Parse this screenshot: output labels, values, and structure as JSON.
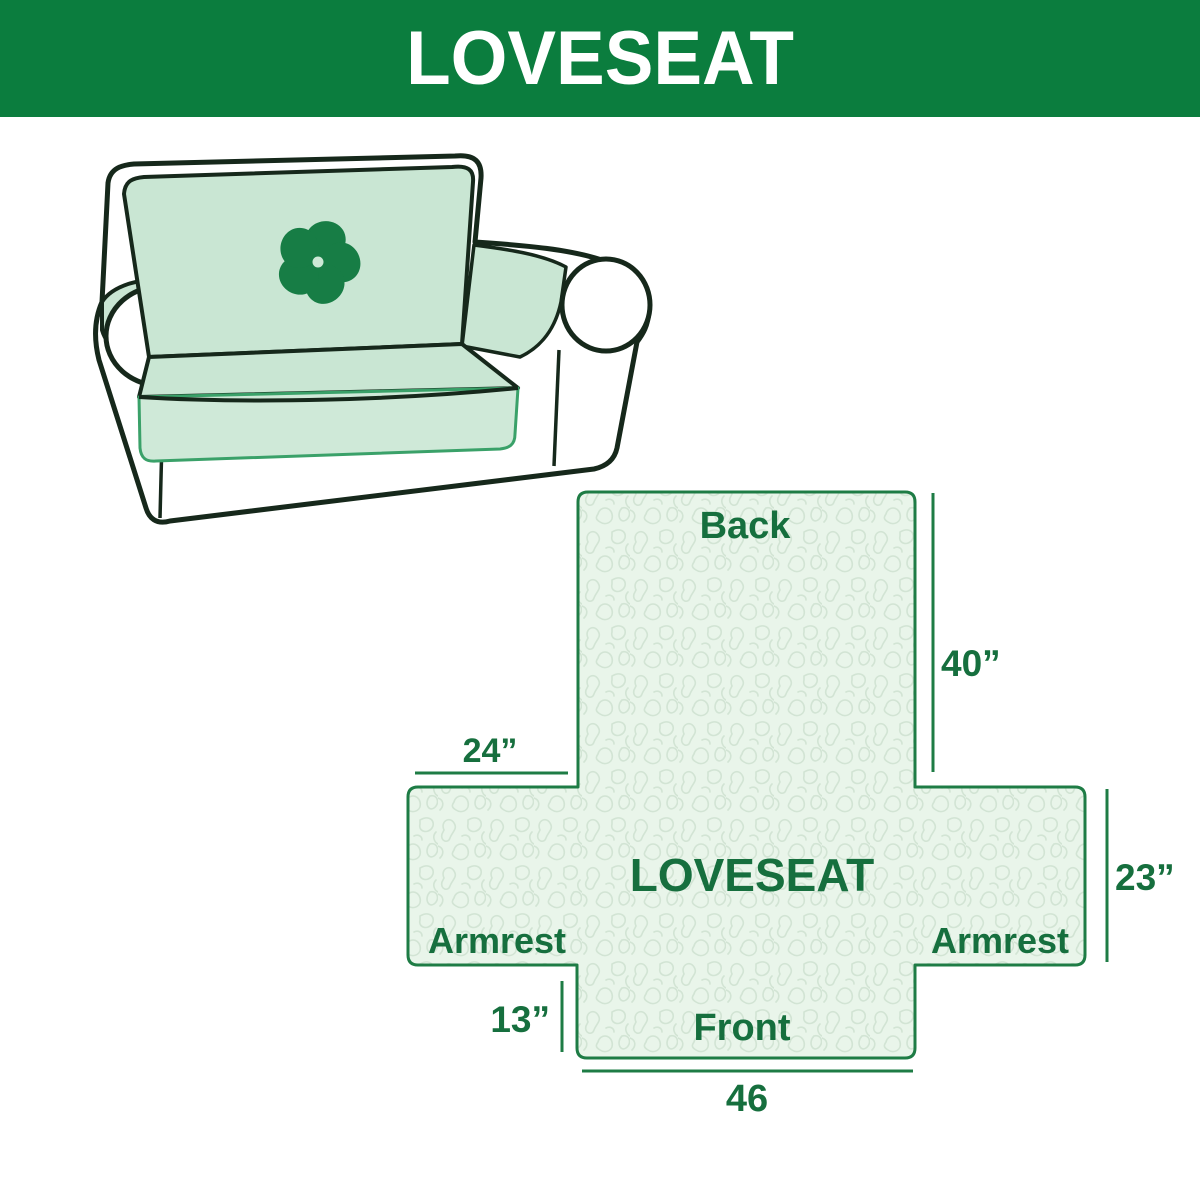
{
  "header": {
    "title": "LOVESEAT"
  },
  "illustration": {
    "alt": "Loveseat sofa wearing a mint protective cover",
    "logo_icon": "pinwheel-icon"
  },
  "diagram": {
    "center_label": "LOVESEAT",
    "back_label": "Back",
    "front_label": "Front",
    "armrest_left_label": "Armrest",
    "armrest_right_label": "Armrest",
    "dims": {
      "back_height": "40”",
      "armrest_top_width": "24”",
      "side_height": "23”",
      "front_skirt_height": "13”",
      "front_width": "46"
    }
  },
  "colors": {
    "header_bg": "#0b7d3e",
    "header_text": "#ffffff",
    "diagram_fill": "#e9f5ea",
    "diagram_pattern_line": "#d2e4d4",
    "diagram_border": "#1e7c45",
    "label_text": "#166f3e",
    "cover_mint": "#c9e6d3",
    "cover_apron_mint": "#cfe9d8",
    "cover_edge_green": "#3aa169",
    "sofa_outline": "#16281b",
    "logo_green": "#177d45"
  }
}
